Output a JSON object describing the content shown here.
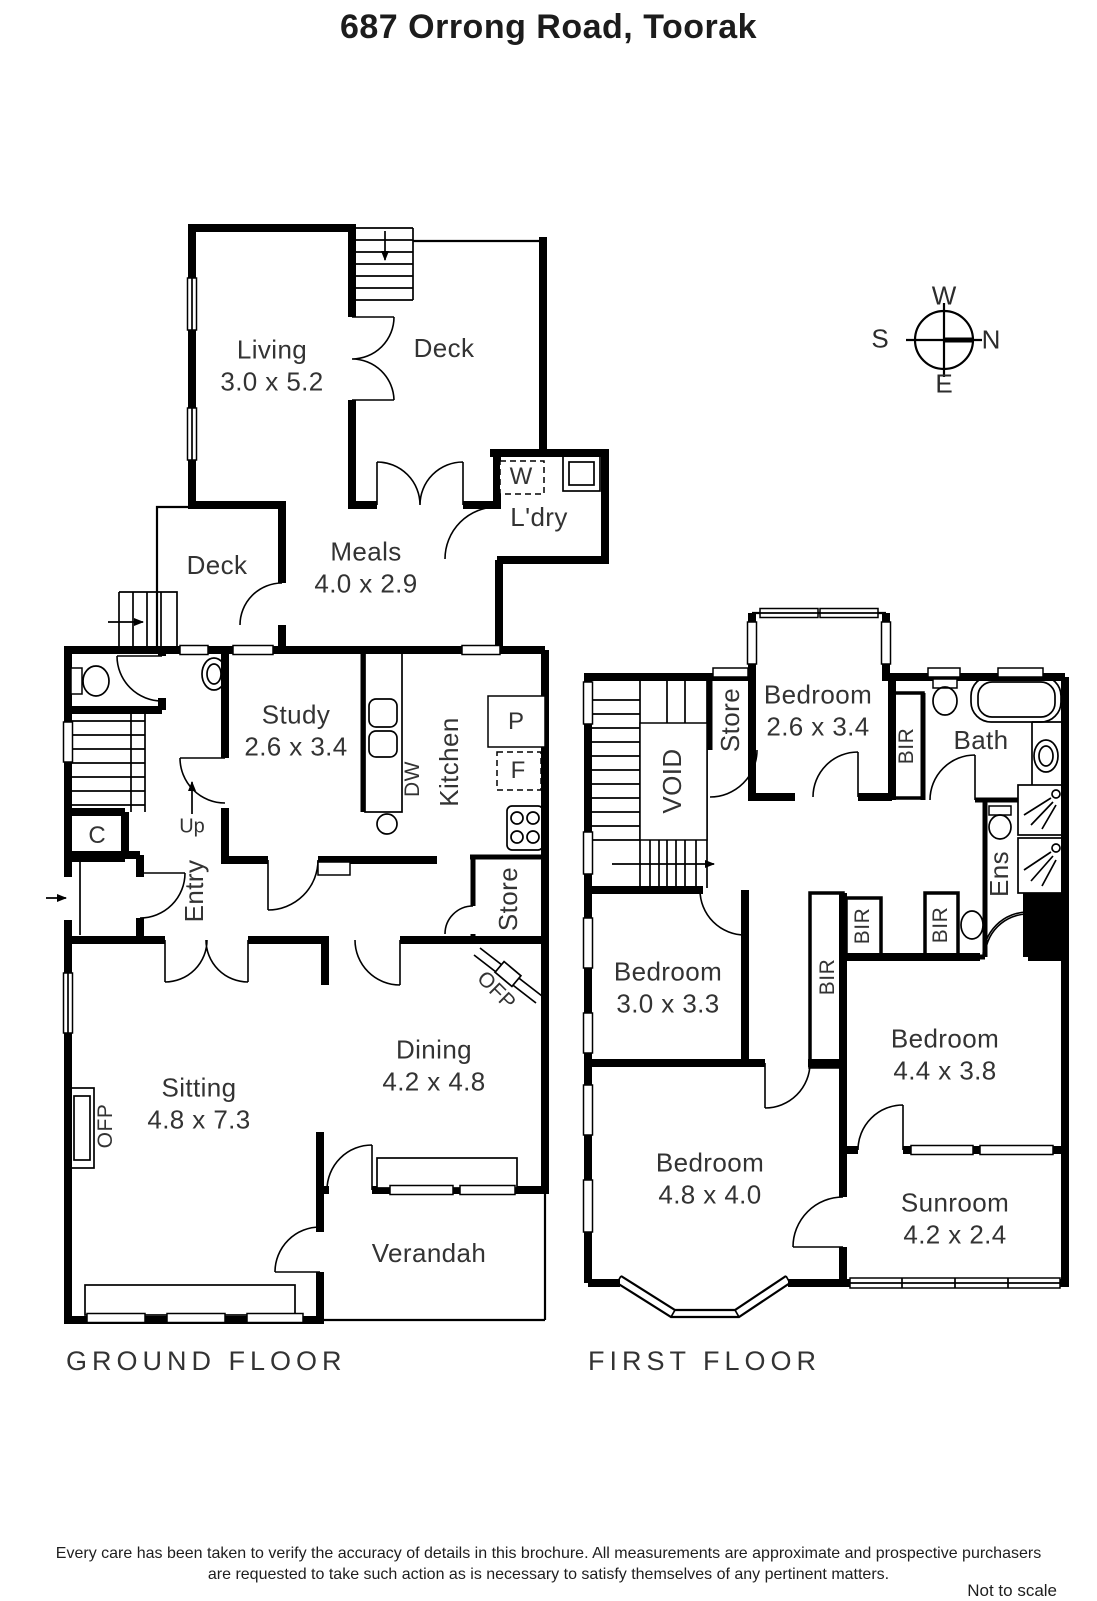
{
  "title": "687 Orrong Road, Toorak",
  "compass": {
    "n": "N",
    "e": "E",
    "s": "S",
    "w": "W"
  },
  "ground_floor": {
    "label": "GROUND FLOOR",
    "rooms": {
      "living": {
        "name": "Living",
        "dims": "3.0 x 5.2"
      },
      "deck_upper": {
        "name": "Deck"
      },
      "deck_lower": {
        "name": "Deck"
      },
      "meals": {
        "name": "Meals",
        "dims": "4.0 x 2.9"
      },
      "laundry": {
        "name": "L'dry"
      },
      "study": {
        "name": "Study",
        "dims": "2.6 x 3.4"
      },
      "kitchen": {
        "name": "Kitchen"
      },
      "store": {
        "name": "Store"
      },
      "entry": {
        "name": "Entry"
      },
      "sitting": {
        "name": "Sitting",
        "dims": "4.8 x 7.3"
      },
      "dining": {
        "name": "Dining",
        "dims": "4.2 x 4.8"
      },
      "verandah": {
        "name": "Verandah"
      }
    },
    "markers": {
      "washer": "W",
      "pantry": "P",
      "fridge": "F",
      "dishwasher": "DW",
      "cupboard": "C",
      "up": "Up",
      "open_fireplace_sitting": "OFP",
      "open_fireplace_dining": "OFP"
    }
  },
  "first_floor": {
    "label": "FIRST FLOOR",
    "rooms": {
      "bedroom_1": {
        "name": "Bedroom",
        "dims": "2.6 x 3.4"
      },
      "bedroom_2": {
        "name": "Bedroom",
        "dims": "3.0 x 3.3"
      },
      "bedroom_3": {
        "name": "Bedroom",
        "dims": "4.4 x 3.8"
      },
      "bedroom_4": {
        "name": "Bedroom",
        "dims": "4.8 x 4.0"
      },
      "sunroom": {
        "name": "Sunroom",
        "dims": "4.2 x 2.4"
      },
      "bath": {
        "name": "Bath"
      },
      "ensuite": {
        "name": "Ens"
      },
      "store": {
        "name": "Store"
      },
      "void": {
        "name": "VOID"
      }
    },
    "markers": {
      "bir_1": "BIR",
      "bir_2": "BIR",
      "bir_3": "BIR",
      "bir_4": "BIR"
    }
  },
  "footer": {
    "line1": "Every care has been taken to verify the accuracy of details in this brochure.  All measurements are approximate and prospective purchasers",
    "line2": "are requested to take such action as is necessary to satisfy themselves of any pertinent matters.",
    "scale_note": "Not to scale"
  }
}
